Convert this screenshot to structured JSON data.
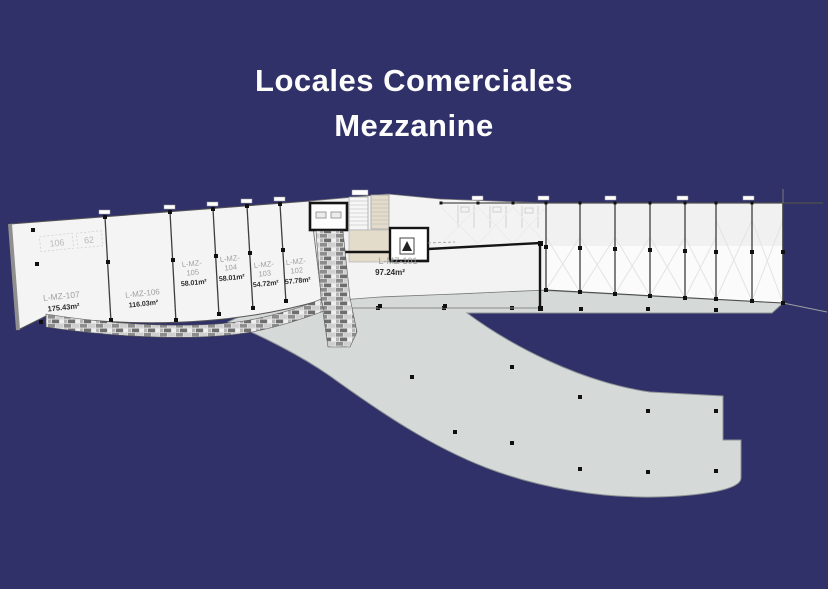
{
  "title": {
    "line1": "Locales Comerciales",
    "line2": "Mezzanine"
  },
  "plan": {
    "small_labels": [
      {
        "text": "106"
      },
      {
        "text": "62"
      }
    ],
    "units": [
      {
        "id": "L-MZ-107",
        "label_lines": [
          "L-MZ-107"
        ],
        "area": "175.43m²"
      },
      {
        "id": "L-MZ-106",
        "label_lines": [
          "L-MZ-106"
        ],
        "area": "116.03m²"
      },
      {
        "id": "L-MZ-105",
        "label_lines": [
          "L-MZ-",
          "105"
        ],
        "area": "58.01m²"
      },
      {
        "id": "L-MZ-104",
        "label_lines": [
          "L-MZ-",
          "104"
        ],
        "area": "58.01m²"
      },
      {
        "id": "L-MZ-103",
        "label_lines": [
          "L-MZ-",
          "103"
        ],
        "area": "54.72m²"
      },
      {
        "id": "L-MZ-102",
        "label_lines": [
          "L-MZ-",
          "102"
        ],
        "area": "57.78m²"
      },
      {
        "id": "L-MZ-101",
        "label_lines": [
          "L-MZ-101"
        ],
        "area": "97.24m²"
      }
    ]
  },
  "colors": {
    "background": "#313169",
    "unit_floor": "#f4f4f4",
    "unit_floor_bright": "#fbfbfb",
    "walkway": "#d5dad9",
    "beige_core": "#e3dccb",
    "wall_dark": "#151515",
    "label_gray": "#a0a0a0",
    "area_text": "#2b2b2b",
    "title_text": "#fdfdfe"
  }
}
